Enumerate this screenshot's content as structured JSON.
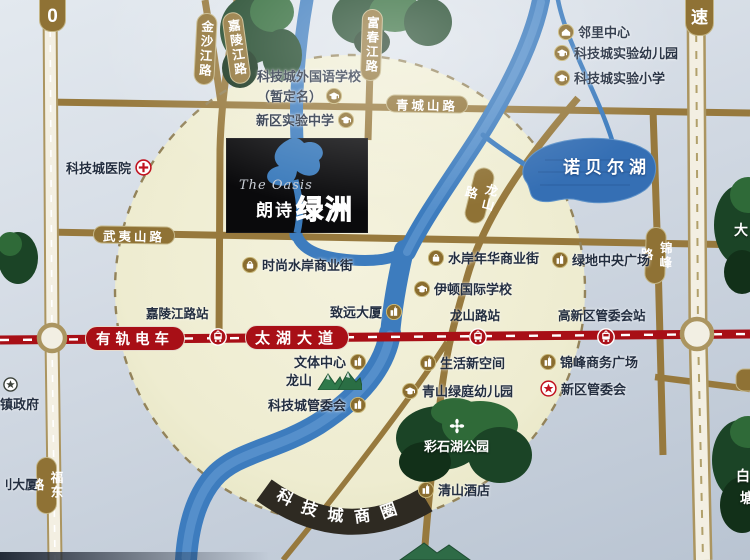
{
  "colors": {
    "background_outer": "#b9c4d2",
    "radius_circle_fill": "#efeed4",
    "road_gold": "#97793d",
    "road_light": "#f3efe2",
    "river_blue": "#3d7cbe",
    "lake_blue": "#356fb4",
    "tram_red": "#a80f16",
    "district_band_dark": "#2e2a22",
    "tree_green": "#1b4426",
    "label_ink": "#232e40",
    "road_capsule_gold": "#8f7235"
  },
  "project_logo": {
    "name_en": "The Oasis",
    "name_cn_part1": "朗诗",
    "name_cn_part2": "绿洲"
  },
  "lake": {
    "label": "诺贝尔湖"
  },
  "district_band": {
    "label": "科技城商圈"
  },
  "badges": {
    "ring_road": "0",
    "highway": "速"
  },
  "tram": {
    "line_badge": "有轨电车",
    "avenue_badge": "太湖大道",
    "stations": [
      {
        "id": "station-jialingjiang",
        "label": "嘉陵江路站",
        "x": 146,
        "y": 303,
        "icon_x": 218
      },
      {
        "id": "station-longshanlu",
        "label": "龙山路站",
        "x": 450,
        "y": 305,
        "icon_x": 478
      },
      {
        "id": "station-gaoxinqu",
        "label": "高新区管委会站",
        "x": 558,
        "y": 305,
        "icon_x": 606
      }
    ]
  },
  "road_labels": [
    {
      "id": "road-jinshajiang",
      "text": "金沙江路",
      "o": "v",
      "x": 195,
      "y": 13,
      "rot": 3
    },
    {
      "id": "road-jialingjiang",
      "text": "嘉陵江路",
      "o": "v",
      "x": 226,
      "y": 12,
      "rot": -8
    },
    {
      "id": "road-fuchunjiang",
      "text": "富春江路",
      "o": "v",
      "x": 361,
      "y": 9,
      "rot": 2
    },
    {
      "id": "road-qingchengshan",
      "text": "青城山路",
      "o": "h",
      "x": 386,
      "y": 95,
      "rot": 1
    },
    {
      "id": "road-wuyishan",
      "text": "武夷山路",
      "o": "h",
      "x": 93,
      "y": 226,
      "rot": 1
    },
    {
      "id": "road-longshan",
      "text": "龙山路",
      "o": "v",
      "x": 469,
      "y": 167,
      "rot": 14
    },
    {
      "id": "road-jinfeng",
      "text": "锦峰路",
      "o": "v",
      "x": 645,
      "y": 227,
      "rot": 2
    },
    {
      "id": "road-fudong",
      "text": "福东路",
      "o": "v",
      "x": 36,
      "y": 457,
      "rot": 0
    }
  ],
  "pois": [
    {
      "id": "poi-tech-city-hospital",
      "label": "科技城医院",
      "icon": "hospital",
      "icon_pos": "after",
      "x": 66,
      "y": 158
    },
    {
      "id": "poi-foreign-lang-school",
      "label": "科技城外国语学校",
      "line2": "（暂定名）",
      "icon": "school",
      "icon_pos": "after",
      "x": 257,
      "y": 66
    },
    {
      "id": "poi-new-district-school",
      "label": "新区实验中学",
      "icon": "school",
      "icon_pos": "after",
      "x": 256,
      "y": 110
    },
    {
      "id": "poi-neighborhood-center",
      "label": "邻里中心",
      "icon": "community",
      "icon_pos": "before",
      "x": 558,
      "y": 22
    },
    {
      "id": "poi-exp-kindergarten",
      "label": "科技城实验幼儿园",
      "icon": "school",
      "icon_pos": "before",
      "x": 554,
      "y": 43
    },
    {
      "id": "poi-exp-primary-school",
      "label": "科技城实验小学",
      "icon": "school",
      "icon_pos": "before",
      "x": 554,
      "y": 68
    },
    {
      "id": "poi-fashion-waterfront",
      "label": "时尚水岸商业街",
      "icon": "shop",
      "icon_pos": "before",
      "x": 242,
      "y": 255
    },
    {
      "id": "poi-waterfront-street",
      "label": "水岸年华商业街",
      "icon": "shop",
      "icon_pos": "before",
      "x": 428,
      "y": 248
    },
    {
      "id": "poi-greenland-plaza",
      "label": "绿地中央广场",
      "icon": "building",
      "icon_pos": "before",
      "x": 552,
      "y": 250
    },
    {
      "id": "poi-eton-school",
      "label": "伊顿国际学校",
      "icon": "school",
      "icon_pos": "before",
      "x": 414,
      "y": 279
    },
    {
      "id": "poi-zhiyuan-tower",
      "label": "致远大厦",
      "icon": "building",
      "icon_pos": "after",
      "x": 330,
      "y": 302
    },
    {
      "id": "poi-culture-center",
      "label": "文体中心",
      "icon": "building",
      "icon_pos": "after",
      "x": 294,
      "y": 352
    },
    {
      "id": "poi-longshan-hill",
      "label": "龙山",
      "icon": "mountain",
      "icon_pos": "after",
      "x": 286,
      "y": 368
    },
    {
      "id": "poi-tech-city-committee",
      "label": "科技城管委会",
      "icon": "building",
      "icon_pos": "after",
      "x": 268,
      "y": 395
    },
    {
      "id": "poi-life-new-space",
      "label": "生活新空间",
      "icon": "building",
      "icon_pos": "before",
      "x": 420,
      "y": 353
    },
    {
      "id": "poi-qingshan-kindergarten",
      "label": "青山绿庭幼儿园",
      "icon": "school",
      "icon_pos": "before",
      "x": 402,
      "y": 381
    },
    {
      "id": "poi-jinfeng-biz-plaza",
      "label": "锦峰商务广场",
      "icon": "building",
      "icon_pos": "before",
      "x": 540,
      "y": 352
    },
    {
      "id": "poi-new-district-committee",
      "label": "新区管委会",
      "icon": "star-red",
      "icon_pos": "before",
      "x": 540,
      "y": 379
    },
    {
      "id": "poi-caishihu-park",
      "label": "彩石湖公园",
      "icon": "flower",
      "icon_pos": "stack",
      "x": 424,
      "y": 418,
      "white": true
    },
    {
      "id": "poi-qingshan-hotel",
      "label": "清山酒店",
      "icon": "building",
      "icon_pos": "before",
      "x": 418,
      "y": 480
    },
    {
      "id": "poi-town-government",
      "label": "镇政府",
      "icon": "star-dark",
      "icon_pos": "stack-left",
      "x": 0,
      "y": 377
    }
  ],
  "edge_fragments": [
    {
      "id": "fragment-tower",
      "text": "刂大厦",
      "x": 0,
      "y": 474,
      "style": "dark"
    },
    {
      "id": "fragment-da",
      "text": "大",
      "x": 734,
      "y": 220,
      "style": "tree"
    },
    {
      "id": "fragment-bai",
      "text": "白",
      "x": 736,
      "y": 466,
      "style": "tree"
    },
    {
      "id": "fragment-tang",
      "text": "塘",
      "x": 740,
      "y": 488,
      "style": "tree"
    }
  ]
}
